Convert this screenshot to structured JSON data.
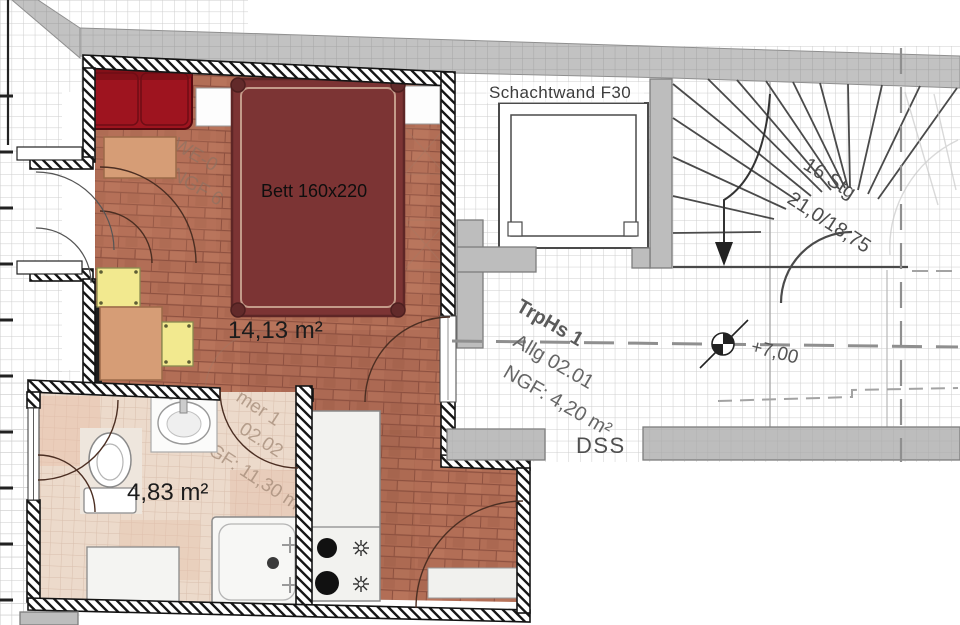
{
  "plan": {
    "labels": {
      "shaft_wall": "Schachtwand F30",
      "door_code": "DSS"
    },
    "rooms": {
      "main_room": {
        "area": "14,13 m²"
      },
      "bathroom": {
        "area": "4,83 m²"
      },
      "stairwell": {
        "name": "TrpHs 1",
        "unit": "Allg 02.01",
        "ngf": "NGF: 4,20 m²"
      }
    },
    "furniture": {
      "bed_label": "Bett 160x220"
    },
    "stair": {
      "steps": "16 Stg",
      "dimensions": "21,0/18,75",
      "level": "+7,00"
    },
    "watermarks": {
      "room_line1": "WE-0",
      "room_line2": "NGF 6",
      "bath_line1": "mer 1",
      "bath_line2": "02.02",
      "bath_line3": "NGF: 11,30 m"
    },
    "colors": {
      "floor_terracotta": "#b26e56",
      "bath_tile": "#ecdacb",
      "bed": "#7c3434",
      "sofa": "#9e141f",
      "table": "#d69d76",
      "chair": "#f2e98f",
      "wall_gray": "#bdbdbd",
      "hatch_black": "#161616",
      "grid_line": "#cdcdcd"
    }
  }
}
